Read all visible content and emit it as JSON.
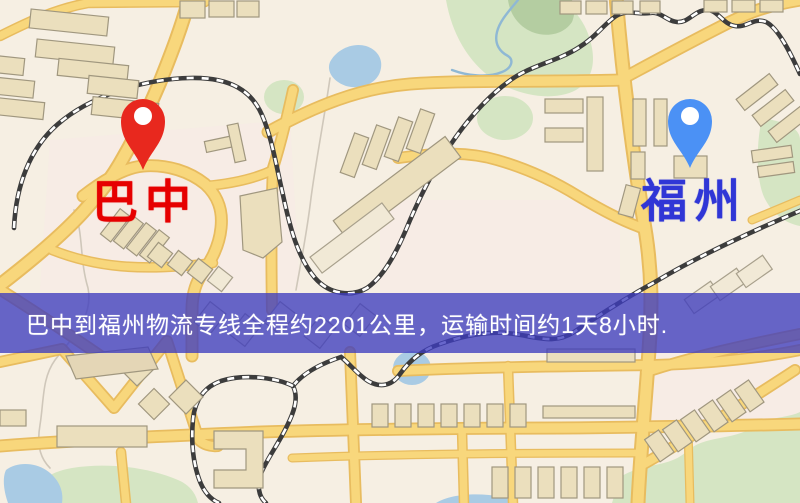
{
  "banner": {
    "text": "巴中到福州物流专线全程约2201公里，运输时间约1天8小时.",
    "background_color": "#3e3cbe",
    "text_color": "#ffffff"
  },
  "route": {
    "origin": {
      "label": "巴中",
      "pin_color": "#e8281e",
      "label_color": "#e60000"
    },
    "destination": {
      "label": "福州",
      "pin_color": "#4b91f5",
      "label_color": "#3036d6"
    },
    "distance_text": "约2201公里",
    "duration_text": "约1天8小时"
  },
  "map": {
    "colors": {
      "background": "#f6efe3",
      "road_fill": "#f8d77c",
      "road_casing": "#e8bc5f",
      "building_fill": "#ebdfbd",
      "park": "#d5e5c3",
      "water": "#a9cbe4",
      "railway": "#3c3c3c"
    }
  }
}
